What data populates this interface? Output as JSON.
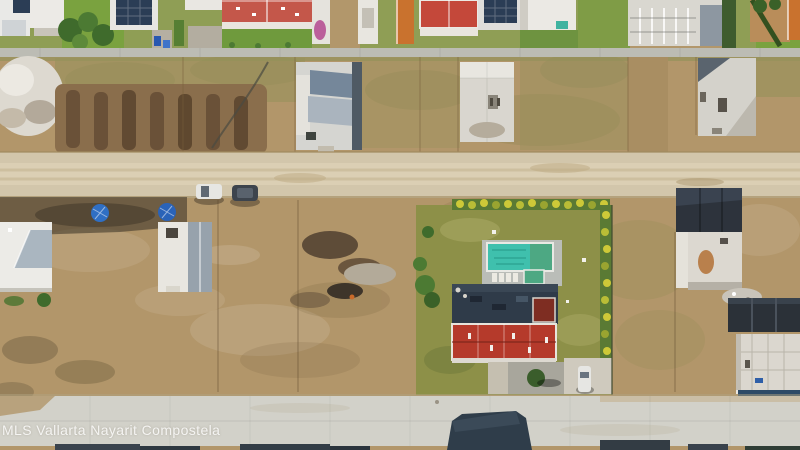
{
  "watermark": {
    "text": "MLS Vallarta Nayarit Compostela"
  },
  "scene": {
    "type": "aerial-drone-photo",
    "subject": "Aerial view of a residential development: finished homes along top street, empty construction lots, a dirt road, a home with lawn and swimming pool, and a concrete street at bottom",
    "features": [
      "finished-homes-row",
      "sidewalk",
      "construction-lots",
      "excavated-trenches",
      "dirt-road",
      "parked-cars",
      "pool-home",
      "swimming-pool",
      "red-tile-roof",
      "concrete-street"
    ]
  },
  "colors": {
    "dirt": "#b2966a",
    "dirt_light": "#c9b189",
    "dirt_dark": "#9d7f56",
    "dirt_road": "#d2c6ab",
    "concrete_road": "#d2d1c9",
    "sidewalk": "#bcbcb4",
    "grass_lush": "#7aa23f",
    "grass_scrub": "#96915a",
    "lawn": "#8d9048",
    "tree_green": "#3f6b2c",
    "trench_brown": "#6a5138",
    "gravel_white": "#ddd9d0",
    "roof_white": "#eceae5",
    "roof_gray": "#97a2ac",
    "roof_red_top": "#c4574a",
    "roof_red_main": "#b53a2b",
    "roof_terracotta": "#c9722e",
    "roof_dark": "#2f3b49",
    "solar_panel": "#2b3d55",
    "pool_water": "#3fc0ad",
    "pool_water_deep": "#4da883",
    "pool_deck": "#babdb8",
    "hedge_yellow": "#cdc938",
    "tarp_blue": "#2f6fc4",
    "car_white": "#e6e6e3",
    "car_dark": "#3d444d",
    "shadow": "#3a342b"
  }
}
